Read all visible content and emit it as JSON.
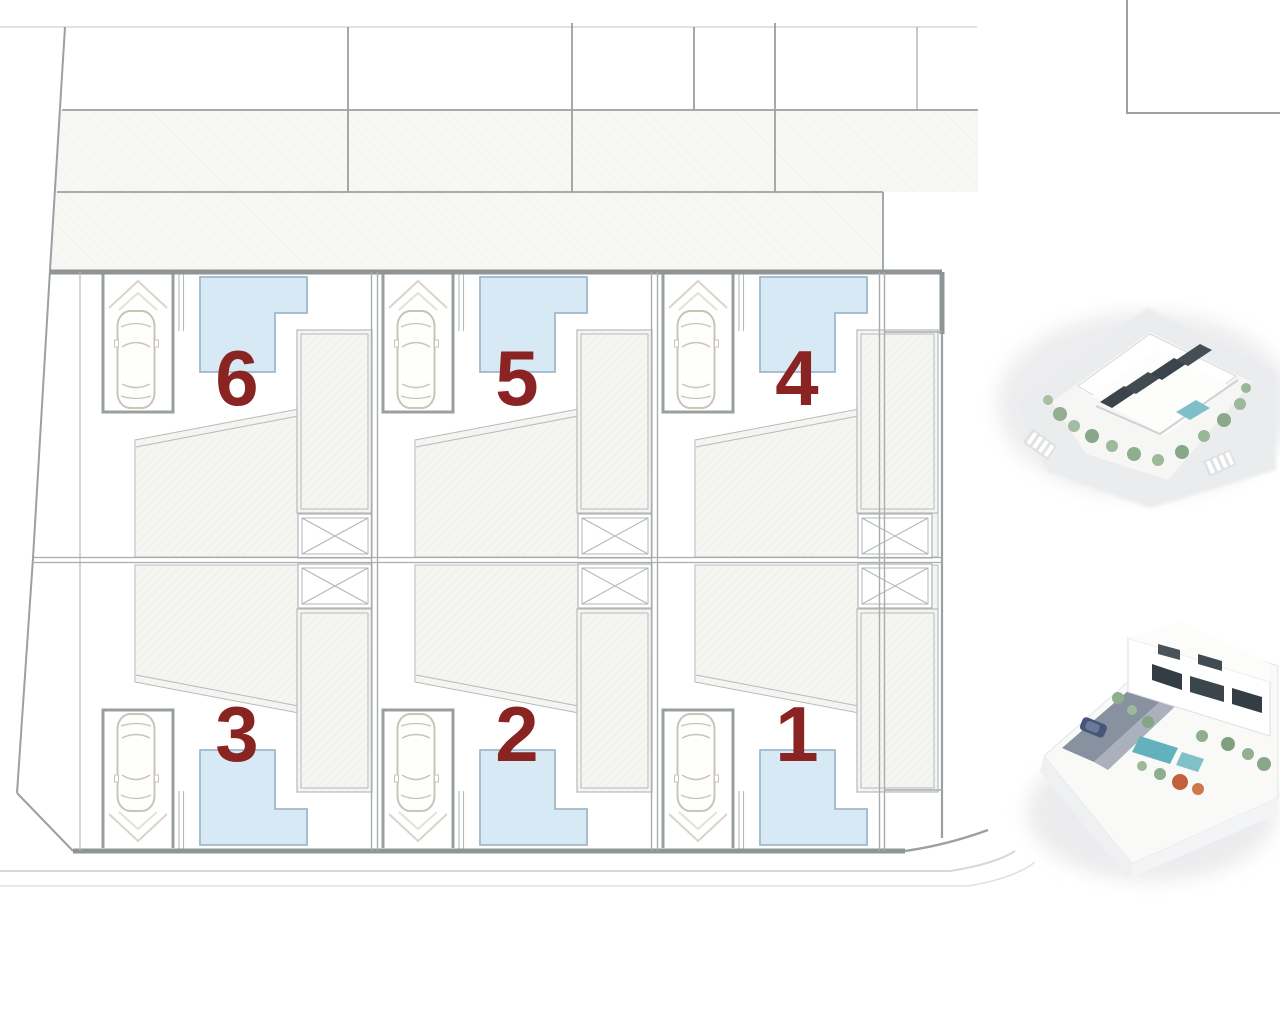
{
  "site_plan": {
    "units": [
      {
        "label": "6",
        "column": 0,
        "row": "top"
      },
      {
        "label": "5",
        "column": 1,
        "row": "top"
      },
      {
        "label": "4",
        "column": 2,
        "row": "top"
      },
      {
        "label": "3",
        "column": 0,
        "row": "bottom"
      },
      {
        "label": "2",
        "column": 1,
        "row": "bottom"
      },
      {
        "label": "1",
        "column": 2,
        "row": "bottom"
      }
    ],
    "colors": {
      "background": "#ffffff",
      "wall_thick": "#8f9596",
      "wall_medium": "#9aa0a3",
      "wall_light": "#b6bbbd",
      "line_faint": "#d6d8d7",
      "hatch_fill": "#f5f5f2",
      "hatch_line": "#e9e9e4",
      "street_hatch_fill": "#f7f7f4",
      "street_hatch_line": "#eeeeea",
      "pool_fill": "#d7e9f4",
      "pool_border": "#9fb9c9",
      "unit_number_color": "#8a2422",
      "car_outline": "#c9c4b6",
      "bay_border": "#9aa09f",
      "render_window": "#3a444a",
      "render_tree": "#8fae8d",
      "render_pool": "#6fb7c3",
      "render_pavement": "#8791a0",
      "render_accent_orange": "#c2623c"
    }
  },
  "renders": {
    "top": {
      "name": "aerial-3d-render"
    },
    "bottom": {
      "name": "street-level-3d-render"
    }
  }
}
